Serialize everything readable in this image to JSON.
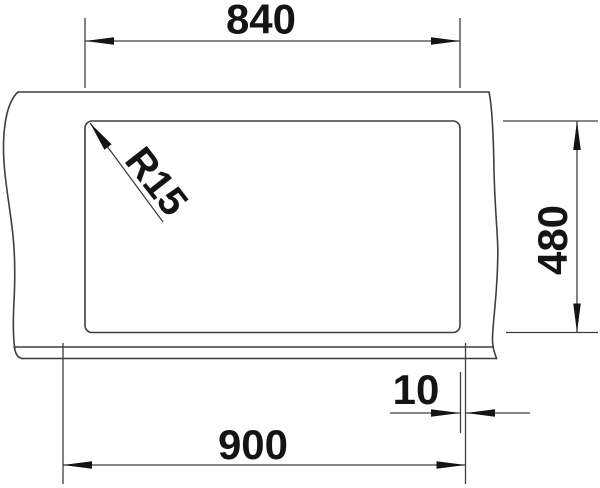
{
  "drawing": {
    "labels": {
      "cutout_width": "840",
      "cutout_height": "480",
      "overall_width": "900",
      "edge_offset": "10",
      "corner_radius": "R15"
    },
    "colors": {
      "line": "#3e3e3e",
      "ink": "#141414",
      "background": "#ffffff"
    }
  }
}
